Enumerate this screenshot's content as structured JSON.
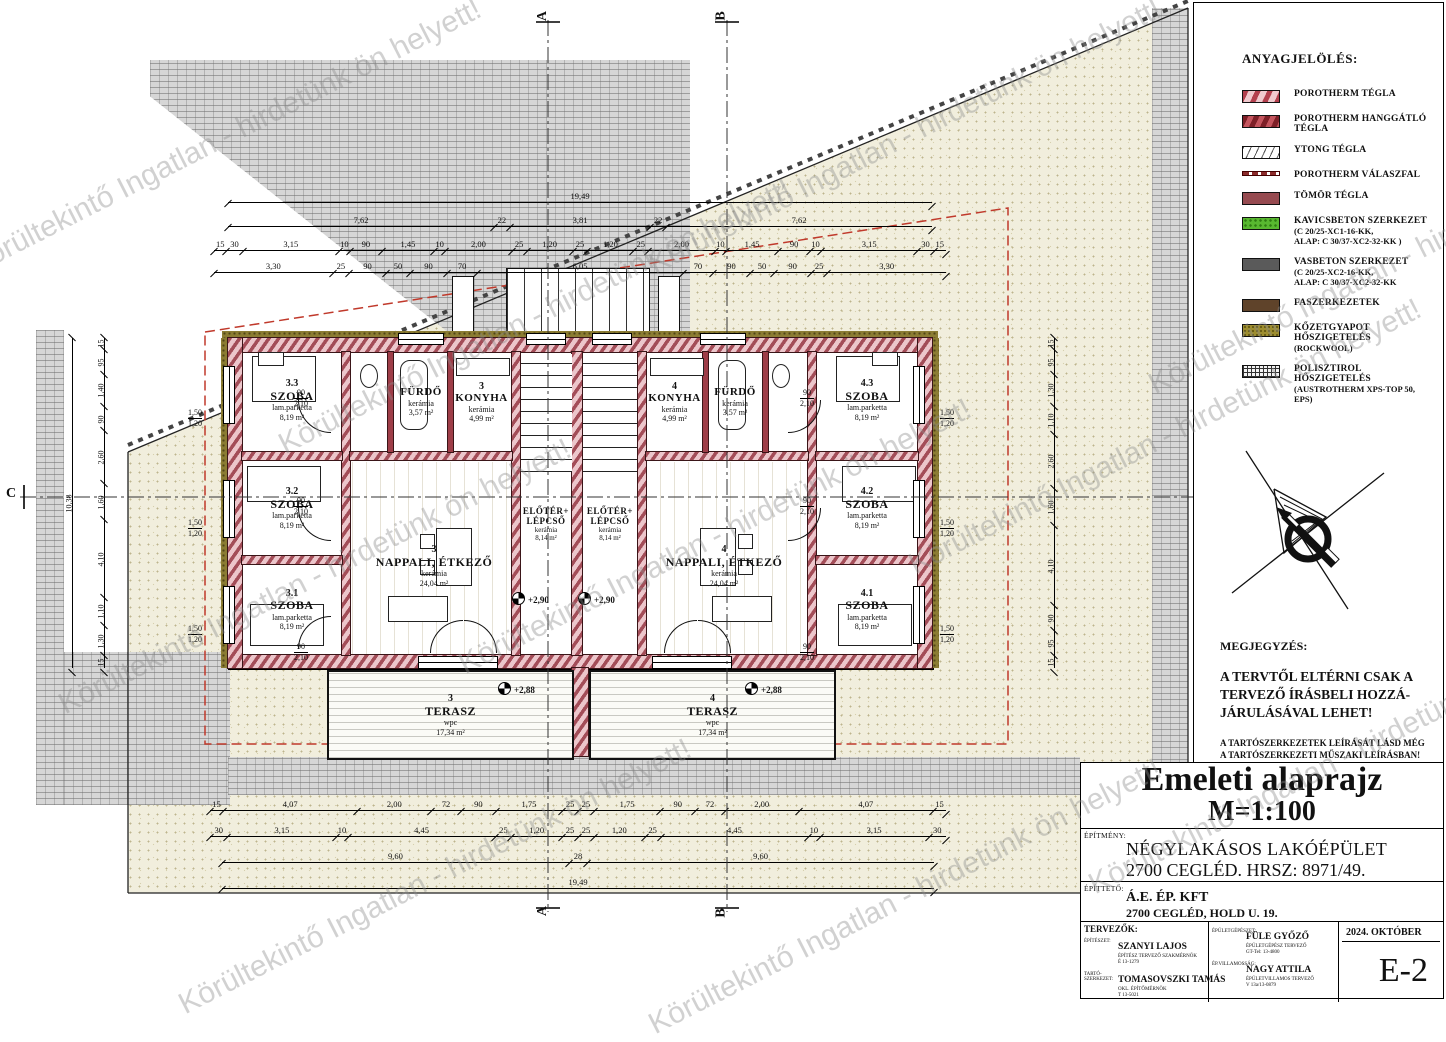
{
  "watermark": {
    "text": "Körültekintő Ingatlan - hirdetünk ön helyett!"
  },
  "markers": {
    "a": "A",
    "b": "B",
    "c": "C"
  },
  "legend": {
    "title": "ANYAGJELÖLÉS:",
    "items": [
      {
        "label": "POROTHERM TÉGLA",
        "line1": "",
        "line2": "",
        "pattern": "porotherm"
      },
      {
        "label": "POROTHERM HANGGÁTLÓ TÉGLA",
        "line1": "",
        "line2": "",
        "pattern": "hanggatlo"
      },
      {
        "label": "YTONG TÉGLA",
        "line1": "",
        "line2": "",
        "pattern": "ytong"
      },
      {
        "label": "POROTHERM VÁLASZFAL",
        "line1": "",
        "line2": "",
        "pattern": "valaszfal"
      },
      {
        "label": "TÖMÖR TÉGLA",
        "line1": "",
        "line2": "",
        "pattern": "tomor"
      },
      {
        "label": "KAVICSBETON SZERKEZET",
        "line1": "(C 20/25-XC1-16-KK,",
        "line2": "ALAP: C 30/37-XC2-32-KK )",
        "pattern": "kavics"
      },
      {
        "label": "VASBETON SZERKEZET",
        "line1": "(C 20/25-XC2-16-KK,",
        "line2": "ALAP: C 30/37-XC2-32-KK",
        "pattern": "vasbeton"
      },
      {
        "label": "FASZERKEZETEK",
        "line1": "",
        "line2": "",
        "pattern": "fa"
      },
      {
        "label": "KŐZETGYAPOT HŐSZIGETELÉS",
        "line1": "(ROCKWOOL)",
        "line2": "",
        "pattern": "rockwool"
      },
      {
        "label": "POLISZTIROL HŐSZIGETELÉS",
        "line1": "(AUSTROTHERM XPS-TOP 50, EPS)",
        "line2": "",
        "pattern": "eps"
      }
    ]
  },
  "notes": {
    "title": "MEGJEGYZÉS:",
    "warning1": "A TERVTŐL ELTÉRNI CSAK A",
    "warning2": "TERVEZŐ ÍRÁSBELI HOZZÁ-",
    "warning3": "JÁRULÁSÁVAL LEHET!",
    "sub1": "A TARTÓSZERKEZETEK LEÍRÁSÁT LÁSD MÉG",
    "sub2": "A TARTÓSZERKEZETI MŰSZAKI LEÍRÁSBAN!"
  },
  "title_block": {
    "title": "Emeleti alaprajz",
    "scale": "M=1:100",
    "building_label": "ÉPÍTMÉNY:",
    "building_line1": "NÉGYLAKÁSOS LAKÓÉPÜLET",
    "building_line2": "2700 CEGLÉD. HRSZ: 8971/49.",
    "client_label": "ÉPÍTTETŐ:",
    "client_line1": "Á.E. ÉP. KFT",
    "client_line2": "2700 CEGLÉD, HOLD U. 19.",
    "designers_label": "TERVEZŐK:",
    "arch_label": "ÉPÍTÉSZET:",
    "arch_name": "SZANYI LAJOS",
    "arch_cred1": "ÉPÍTÉSZ TERVEZŐ SZAKMÉRNÖK",
    "arch_cred2": "É 13-1279",
    "struct_label": "TARTÓ-SZERKEZET:",
    "struct_name": "TOMASOVSZKI TAMÁS",
    "struct_cred1": "OKL. ÉPÍTŐMÉRNÖK",
    "struct_cred2": "T 13-5021",
    "mech_label": "ÉPÜLETGÉPÉSZET:",
    "mech_name": "FÜLE GYŐZŐ",
    "mech_cred1": "ÉPÜLETGÉPÉSZ TERVEZŐ",
    "mech_cred2": "GT-Tel: 13-4800",
    "elec_label": "ÉP.VILLAMOSSÁG:",
    "elec_name": "NAGY ATTILA",
    "elec_cred1": "ÉPÜLETVILLAMOS TERVEZŐ",
    "elec_cred2": "V 13a/13-0879",
    "date": "2024. OKTÓBER",
    "sheet": "E-2"
  },
  "plan": {
    "rooms": [
      {
        "slot": "r33",
        "num": "3.3",
        "name": "SZOBA",
        "mat": "lam.parketta",
        "area": "8,19 m²"
      },
      {
        "slot": "r32",
        "num": "3.2",
        "name": "SZOBA",
        "mat": "lam.parketta",
        "area": "8,19 m²"
      },
      {
        "slot": "r31",
        "num": "3.1",
        "name": "SZOBA",
        "mat": "lam.parketta",
        "area": "8,19 m²"
      },
      {
        "slot": "fur3",
        "num": "",
        "name": "FÜRDŐ",
        "mat": "kerámia",
        "area": "3,57 m²"
      },
      {
        "slot": "kony3",
        "num": "3",
        "name": "KONYHA",
        "mat": "kerámia",
        "area": "4,99 m²"
      },
      {
        "slot": "nap3",
        "num": "3",
        "name": "NAPPALI, ÉTKEZŐ",
        "mat": "kerámia",
        "area": "24,04 m²"
      },
      {
        "slot": "elo1",
        "num": "",
        "name": "ELŐTÉR+ LÉPCSŐ",
        "mat": "kerámia",
        "area": "8,14 m²"
      },
      {
        "slot": "elo2",
        "num": "",
        "name": "ELŐTÉR+ LÉPCSŐ",
        "mat": "kerámia",
        "area": "8,14 m²"
      },
      {
        "slot": "kony4",
        "num": "4",
        "name": "KONYHA",
        "mat": "kerámia",
        "area": "4,99 m²"
      },
      {
        "slot": "fur4",
        "num": "",
        "name": "FÜRDŐ",
        "mat": "kerámia",
        "area": "3,57 m²"
      },
      {
        "slot": "nap4",
        "num": "4",
        "name": "NAPPALI, ÉTKEZŐ",
        "mat": "kerámia",
        "area": "24,04 m²"
      },
      {
        "slot": "r43",
        "num": "4.3",
        "name": "SZOBA",
        "mat": "lam.parketta",
        "area": "8,19 m²"
      },
      {
        "slot": "r42",
        "num": "4.2",
        "name": "SZOBA",
        "mat": "lam.parketta",
        "area": "8,19 m²"
      },
      {
        "slot": "r41",
        "num": "4.1",
        "name": "SZOBA",
        "mat": "lam.parketta",
        "area": "8,19 m²"
      },
      {
        "slot": "ter3",
        "num": "3",
        "name": "TERASZ",
        "mat": "wpc",
        "area": "17,34 m²"
      },
      {
        "slot": "ter4",
        "num": "4",
        "name": "TERASZ",
        "mat": "wpc",
        "area": "17,34 m²"
      }
    ],
    "levels": {
      "stair": "+2,90",
      "terrace": "+2,88"
    },
    "dims": {
      "top_total": [
        "19,49"
      ],
      "top_main": [
        "7,62",
        "22",
        "3,81",
        "22",
        "7,62"
      ],
      "top_d1": [
        "15",
        "30",
        "3,15",
        "10",
        "90",
        "1,45",
        "10",
        "2,00",
        "25",
        "1,20",
        "25",
        "1,20",
        "25",
        "2,00",
        "10",
        "1,45",
        "90",
        "10",
        "3,15",
        "30",
        "15"
      ],
      "top_d2": [
        "3,30",
        "25",
        "90",
        "50",
        "90",
        "70",
        "6,05",
        "70",
        "90",
        "50",
        "90",
        "25",
        "3,30"
      ],
      "bot_d1": [
        "15",
        "4,07",
        "2,00",
        "72",
        "90",
        "1,75",
        "25",
        "25",
        "1,75",
        "90",
        "72",
        "2,00",
        "4,07",
        "15"
      ],
      "bot_d2": [
        "30",
        "3,15",
        "10",
        "4,45",
        "25",
        "1,20",
        "25",
        "25",
        "1,20",
        "25",
        "4,45",
        "10",
        "3,15",
        "30"
      ],
      "bot_d3": [
        "9,60",
        "28",
        "9,60"
      ],
      "bot_total": [
        "19,49"
      ],
      "left_v": [
        "15",
        "95",
        "1,40",
        "90",
        "2,60",
        "1,60",
        "4,10",
        "1,10",
        "1,30",
        "15"
      ],
      "left_total": [
        "10,38"
      ],
      "right_v": [
        "15",
        "95",
        "1,30",
        "1,10",
        "2,60",
        "1,60",
        "4,10",
        "90",
        "95",
        "15"
      ],
      "door_w": "90",
      "door_h": "2,10",
      "win_a": "1,50",
      "win_b": "1,20"
    }
  }
}
